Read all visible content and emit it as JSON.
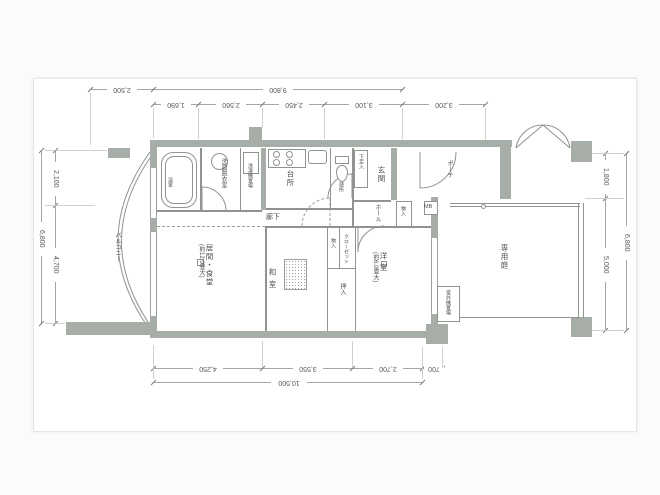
{
  "drawing": {
    "type": "apartment-floor-plan",
    "dims": {
      "top_outer": [
        "2,500",
        "9,800"
      ],
      "top_inner": [
        "1,690",
        "2,560",
        "2,450",
        "3,100",
        "3,200"
      ],
      "bottom_inner": [
        "4,250",
        "3,550",
        "2,700",
        "700"
      ],
      "bottom_outer": [
        "10,500"
      ],
      "left_outer": "6,800",
      "left_inner": [
        "2,100",
        "4,700"
      ],
      "right_outer": "6,800",
      "right_inner": [
        "1,800",
        "5,000"
      ]
    },
    "rooms": {
      "balcony": "バルコニー",
      "living_dining": "居間・食堂",
      "living_dining_size": "(約12.0畳大)",
      "japanese_room": "和室",
      "western_room": "洋室",
      "western_room_size": "(約6.0畳大)",
      "kitchen": "台所",
      "bathroom": "浴室",
      "washroom": "洗面脱衣室",
      "laundry": "洗濯機置場",
      "toilet": "便所",
      "corridor": "廊下",
      "hall": "ホール",
      "entrance": "玄関",
      "shoe_box": "下足入",
      "entrance_storage": "物入",
      "closet": "クローゼット",
      "side_storage": "物入",
      "oshiire": "押入",
      "porch": "ポーチ",
      "meter_box": "MB",
      "outdoor_unit_space": "室外機置場",
      "private_garden": "専用庭"
    },
    "colors": {
      "wall_fill": "#a7aea8",
      "partition_line": "#8f948f",
      "dimension_text": "#565b56",
      "sheet": "#ffffff"
    }
  }
}
